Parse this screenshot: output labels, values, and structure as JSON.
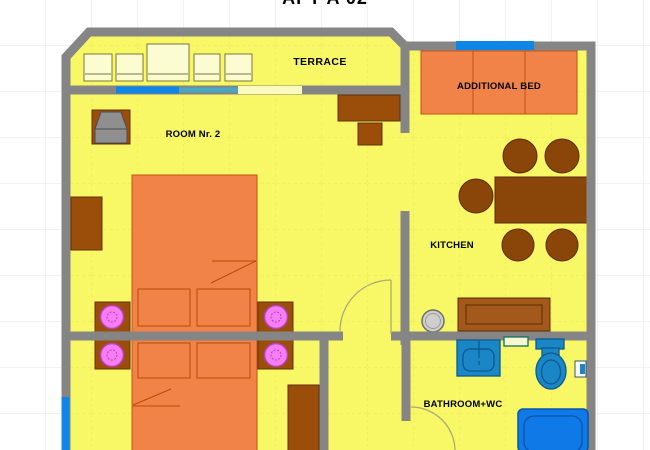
{
  "title": "APT A 02",
  "labels": {
    "terrace": "TERRACE",
    "room2": "ROOM Nr. 2",
    "additional_bed": "ADDITIONAL BED",
    "kitchen": "KITCHEN",
    "bathroom": "BATHROOM+WC"
  },
  "palette": {
    "wall_gray": "#858585",
    "floor_yellow": "#f8f766",
    "floor_grid": "#e9e954",
    "page_grid": "#e2e6ea",
    "furniture_brown": "#9b4e0a",
    "dining_brown": "#8a4508",
    "counter_brown": "#a4591c",
    "bed_orange": "#f18349",
    "lamp_pink": "#f57df5",
    "fixture_blue": "#1b86c6",
    "bathtub_blue": "#1079e8",
    "window_blue": "#0d86e8",
    "terrace_chair_cream": "#fcfcd2",
    "tv_gray": "#8f8f8f"
  },
  "furniture_inventory": [
    "terrace-chair x4",
    "terrace-table",
    "tv-set",
    "desk",
    "stool",
    "wardrobe x2",
    "double-bed x2",
    "pillow x4",
    "nightstand-with-lamp x4",
    "additional-bed",
    "dining-table",
    "dining-chair x5",
    "kitchen-counter",
    "kitchen-round-sink",
    "bathroom-sink",
    "toilet",
    "bathtub",
    "shelf",
    "paper-holder",
    "window x3",
    "door-arc x2"
  ]
}
